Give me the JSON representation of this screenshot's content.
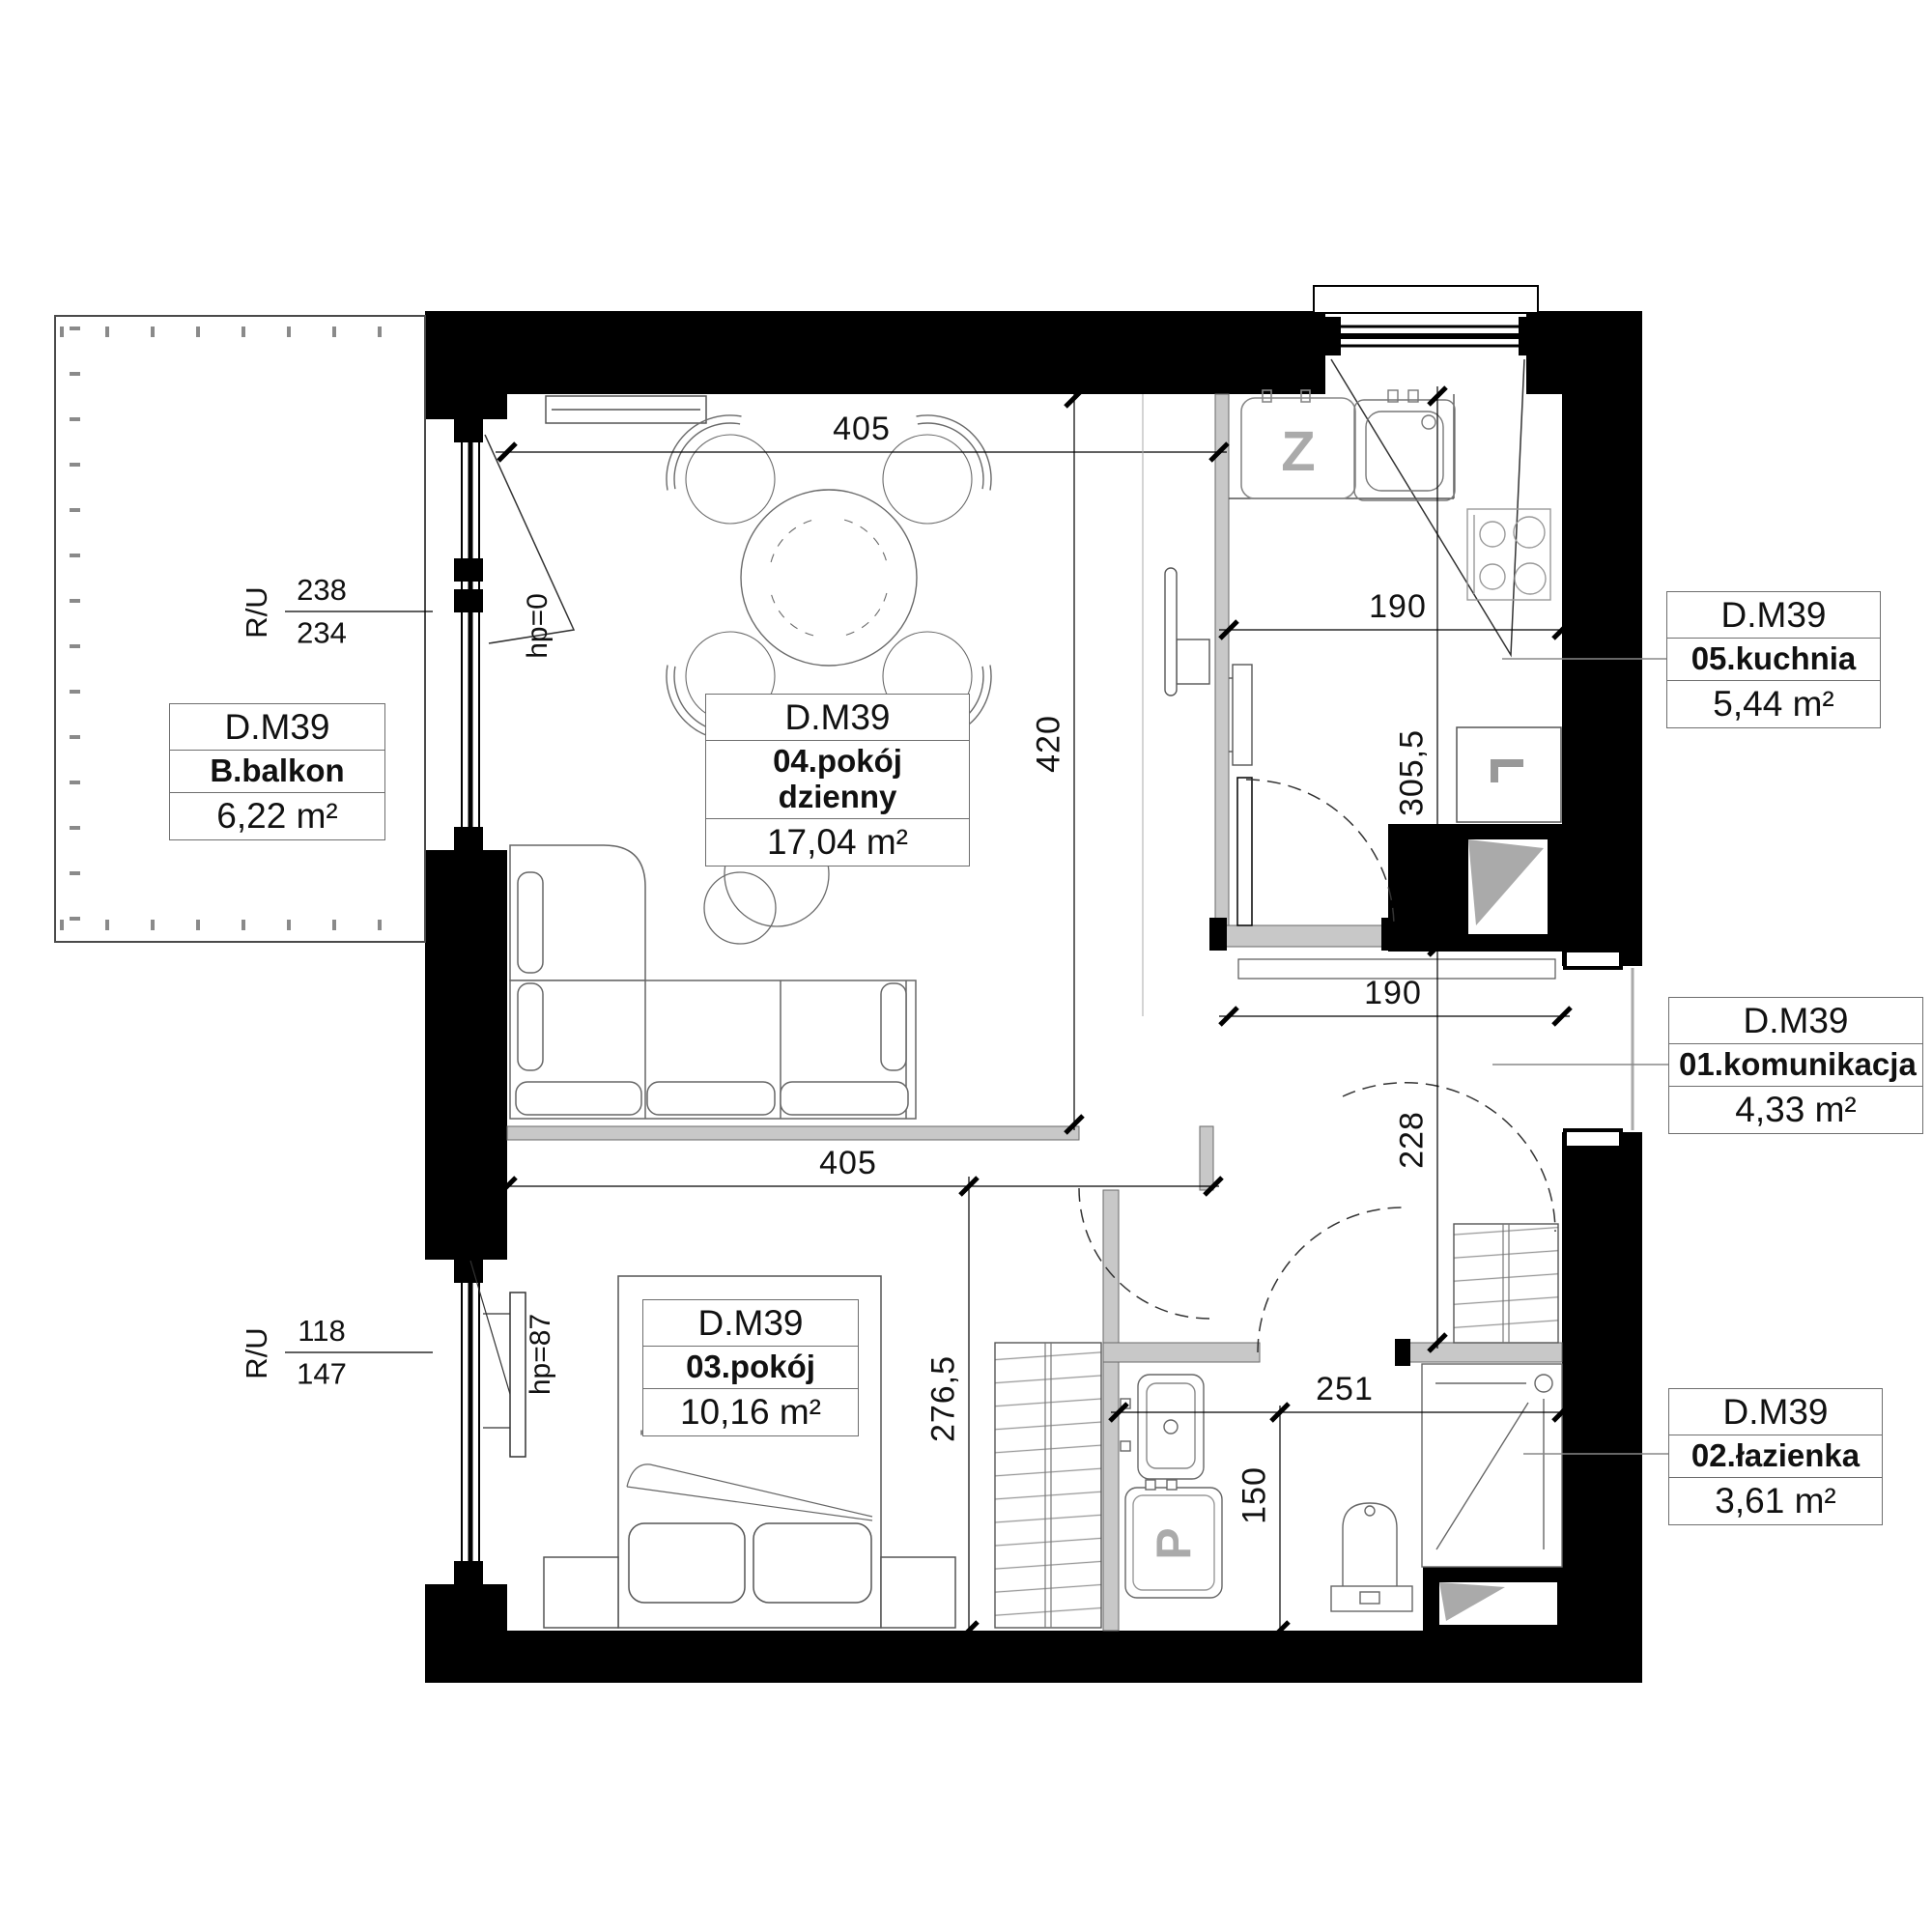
{
  "plan_title": "D.M39",
  "labels": {
    "balcony": {
      "unit": "D.M39",
      "room": "B.balkon",
      "area": "6,22 m²"
    },
    "living": {
      "unit": "D.M39",
      "room": "04.pokój dzienny",
      "area": "17,04 m²"
    },
    "kitchen": {
      "unit": "D.M39",
      "room": "05.kuchnia",
      "area": "5,44 m²"
    },
    "hall": {
      "unit": "D.M39",
      "room": "01.komunikacja",
      "area": "4,33 m²"
    },
    "bedroom": {
      "unit": "D.M39",
      "room": "03.pokój",
      "area": "10,16 m²"
    },
    "bathroom": {
      "unit": "D.M39",
      "room": "02.łazienka",
      "area": "3,61 m²"
    }
  },
  "dimensions": {
    "living_width": "405",
    "living_depth": "420",
    "kitchen_width": "190",
    "kitchen_depth": "305,5",
    "hall_width": "190",
    "hall_depth": "228",
    "bedroom_width": "405",
    "bedroom_depth": "276,5",
    "bathroom_width": "251",
    "bathroom_depth": "150"
  },
  "openings": {
    "balcony_door": {
      "type_label": "R/U",
      "width": "238",
      "height": "234",
      "sill": "hp=0"
    },
    "bedroom_window": {
      "type_label": "R/U",
      "width": "118",
      "height": "147",
      "sill": "hp=87"
    }
  },
  "appliances": {
    "dishwasher": "Z",
    "washing_machine": "P"
  },
  "colors": {
    "wall": "#000000",
    "partition": "#c8c8c8",
    "hatch": "#9a9a9a",
    "dash": "#333333"
  }
}
